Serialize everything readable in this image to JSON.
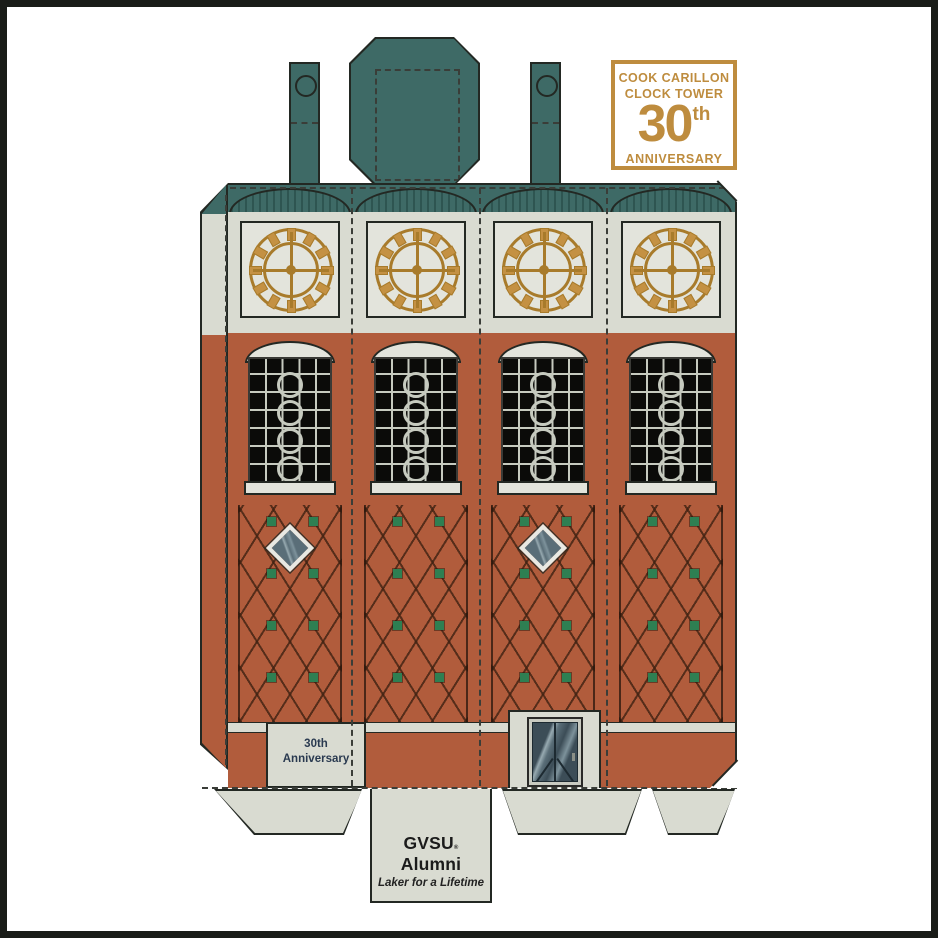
{
  "badge": {
    "line1": "COOK CARILLON",
    "line2": "CLOCK TOWER",
    "number": "30",
    "suffix": "th",
    "line3": "ANNIVERSARY"
  },
  "base_label": {
    "line1": "30th",
    "line2": "Anniversary"
  },
  "bottom_tab": {
    "brand_first": "GVSU",
    "brand_mark": "®",
    "brand_second": "Alumni",
    "tagline": "Laker for a Lifetime"
  },
  "colors": {
    "teal": "#3E6A66",
    "teal-dark": "#2E5551",
    "cream": "#D9DBD1",
    "cream-light": "#E3E4DC",
    "brick": "#B15C3C",
    "outline": "#232823",
    "grid": "#C6CABF",
    "win": "#0B0B09",
    "gold": "#C49143",
    "gold-dark": "#A87B2B",
    "green": "#2E7F52",
    "badge-gold": "#BE8C3E",
    "navy": "#2A3A50",
    "glass": "#5A6E78",
    "glass-light": "#97AAB1",
    "door-dark": "#3C4D57",
    "ink": "#1B1B1B",
    "frame": "#1A1C18",
    "dash": "#3A3D38",
    "white": "#FFFFFF"
  }
}
